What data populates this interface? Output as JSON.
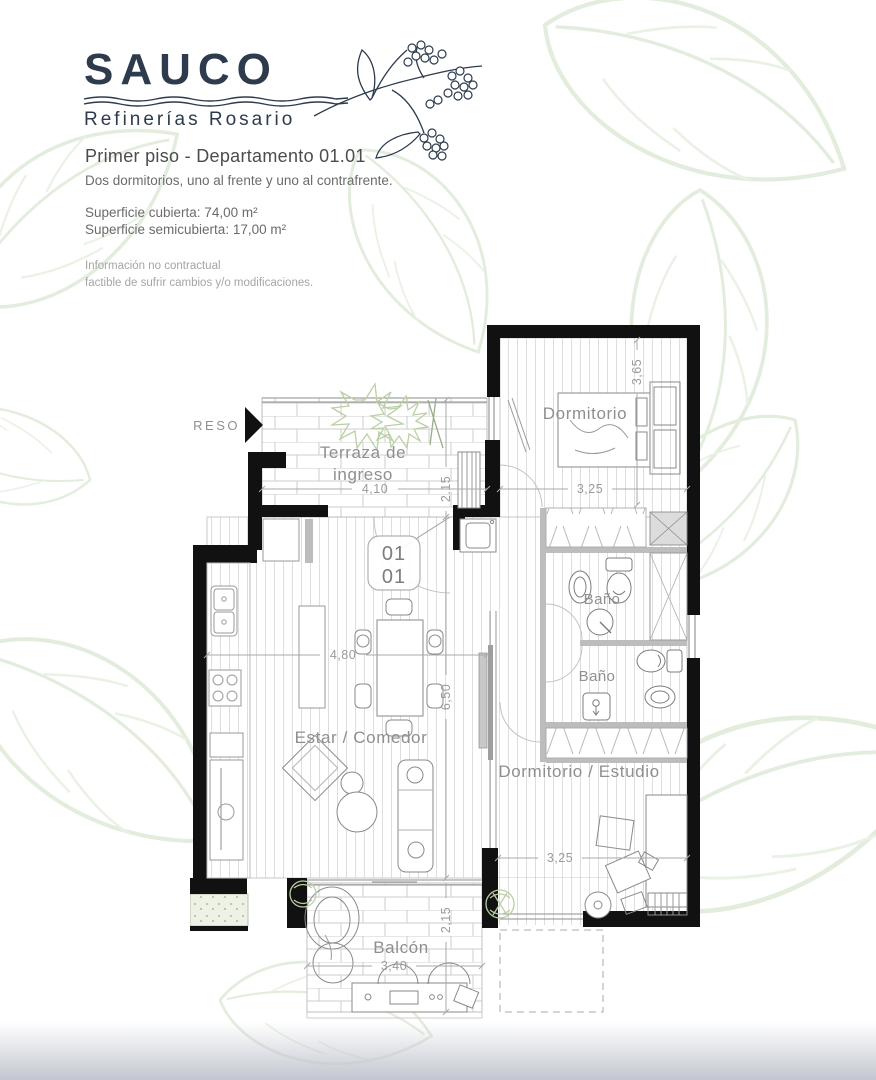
{
  "brand": {
    "name": "SAUCO",
    "tagline": "Refinerías Rosario"
  },
  "header": {
    "title": "Primer piso - Departamento 01.01",
    "subtitle": "Dos dormitorios, uno al  frente y uno al contrafrente.",
    "surface_covered": "Superficie cubierta:  74,00 m²",
    "surface_semi": "Superficie semicubierta: 17,00 m²",
    "disclaimer1": "Información no contractual",
    "disclaimer2": "factible de sufrir cambios y/o modificaciones."
  },
  "plan": {
    "entry_label": "INGRESO",
    "unit": {
      "top": "01",
      "bottom": "01"
    },
    "labels": {
      "terraza1": "Terraza de",
      "terraza2": "ingreso",
      "dormitorio": "Dormitorio",
      "bano1": "Baño",
      "bano2": "Baño",
      "estar": "Estar / Comedor",
      "dorm_estudio": "Dormitorio / Estudio",
      "balcon": "Balcón"
    },
    "dimensions": {
      "terraza_w": "4,10",
      "terraza_d": "2,15",
      "dorm_w": "3,25",
      "dorm_d": "3,65",
      "estar_w": "4,80",
      "estar_d": "6,50",
      "dorm2_w": "3,25",
      "balcon_w": "3,40",
      "balcon_d": "2,15"
    }
  },
  "colors": {
    "brand_navy": "#2d3b4d",
    "walls": "#111111",
    "label_gray": "#8f8f8f",
    "leaf_green": "#e3edde",
    "footer_gradient": "#c3c6d0"
  }
}
